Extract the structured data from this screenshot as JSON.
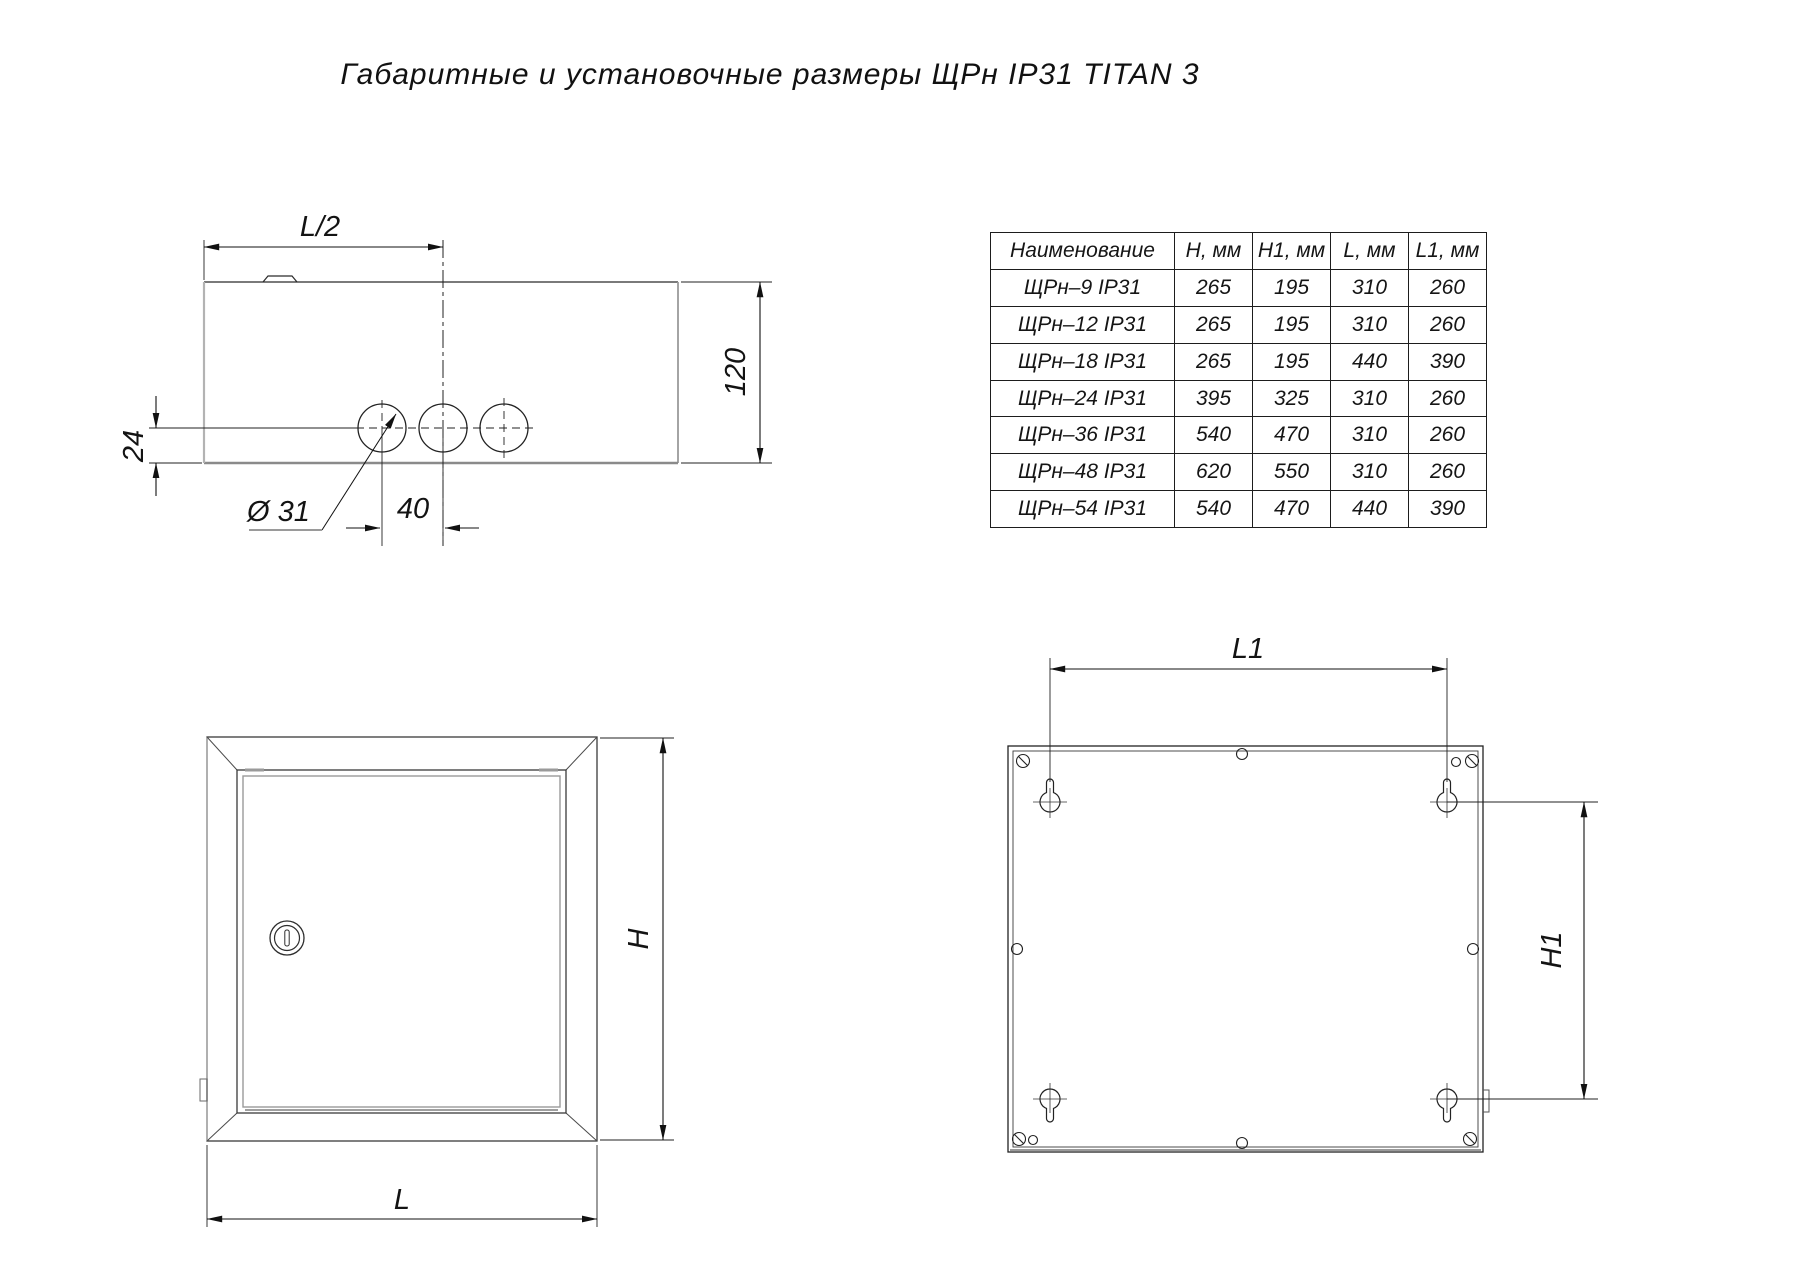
{
  "title": "Габаритные и установочные размеры ЩРн IP31 TITAN 3",
  "table": {
    "headers": [
      "Наименование",
      "H, мм",
      "H1, мм",
      "L, мм",
      "L1, мм"
    ],
    "rows": [
      [
        "ЩРн–9 IP31",
        "265",
        "195",
        "310",
        "260"
      ],
      [
        "ЩРн–12 IP31",
        "265",
        "195",
        "310",
        "260"
      ],
      [
        "ЩРн–18 IP31",
        "265",
        "195",
        "440",
        "390"
      ],
      [
        "ЩРн–24 IP31",
        "395",
        "325",
        "310",
        "260"
      ],
      [
        "ЩРн–36 IP31",
        "540",
        "470",
        "310",
        "260"
      ],
      [
        "ЩРн–48 IP31",
        "620",
        "550",
        "310",
        "260"
      ],
      [
        "ЩРн–54 IP31",
        "540",
        "470",
        "440",
        "390"
      ]
    ]
  },
  "labels": {
    "top_half_width": "L/2",
    "depth": "120",
    "hole_offset": "24",
    "hole_diameter": "Ø 31",
    "hole_spacing": "40",
    "front_height": "H",
    "front_width": "L",
    "mount_width": "L1",
    "mount_height": "H1"
  },
  "colors": {
    "line": "#1d1d1d",
    "grey_line": "#9a9a9a",
    "text": "#131313"
  }
}
